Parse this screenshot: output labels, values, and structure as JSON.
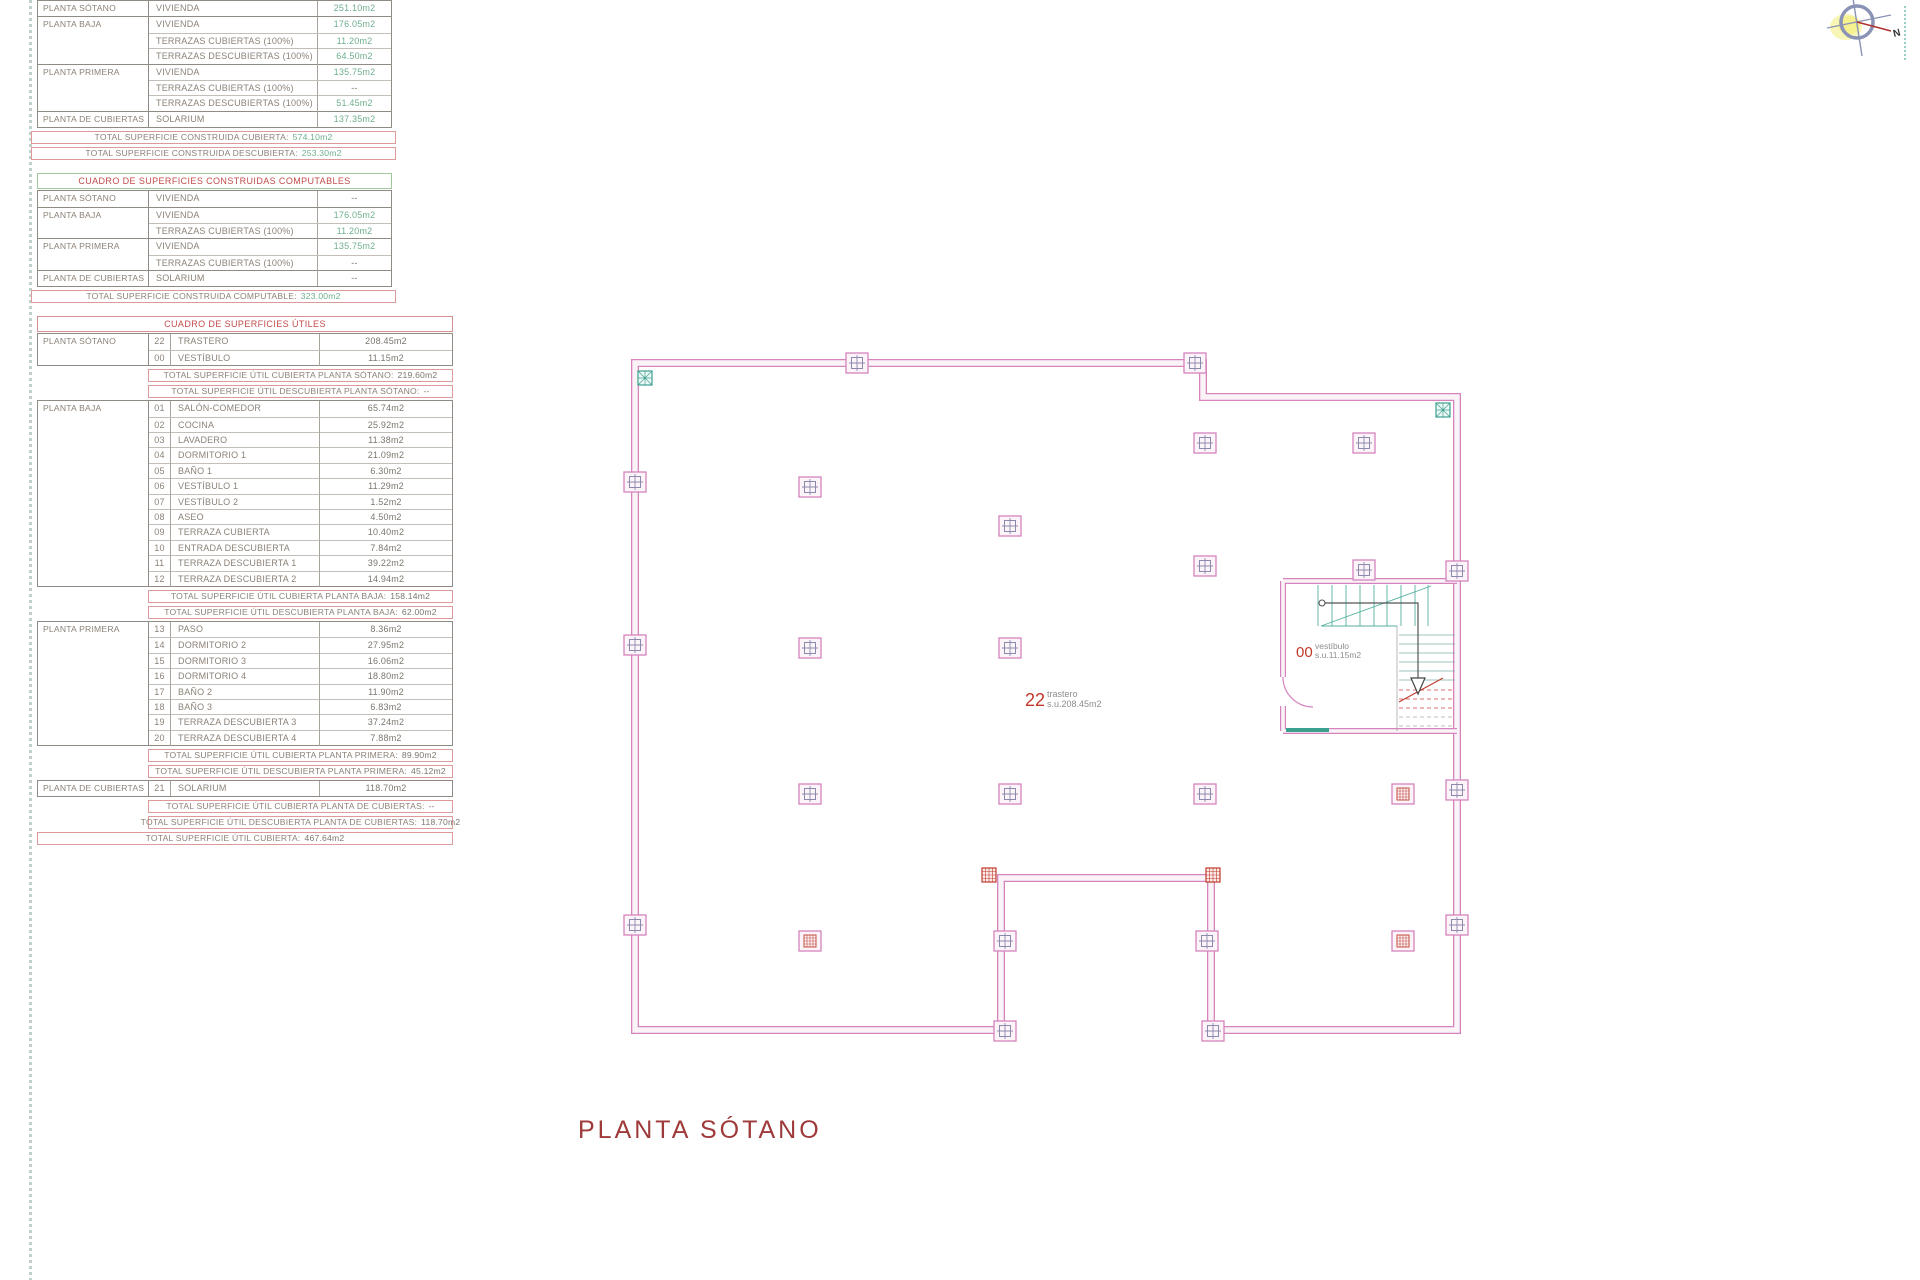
{
  "colors": {
    "wall_pink": "#d584bd",
    "teal": "#3ba08f",
    "red_accent": "#c0392b",
    "value_green": "#6fae8f",
    "title_red": "#9e3a3a",
    "total_bar_border": "#dc9a9a"
  },
  "tables": [
    {
      "name": "cuadro-superficies-construidas",
      "title": null,
      "value_color": "green",
      "has_num_col": false,
      "groups": [
        {
          "planta": "PLANTA SÓTANO",
          "rows": [
            {
              "name": "VIVIENDA",
              "value": "251.10m2"
            }
          ]
        },
        {
          "planta": "PLANTA BAJA",
          "rows": [
            {
              "name": "VIVIENDA",
              "value": "176.05m2"
            },
            {
              "name": "TERRAZAS CUBIERTAS (100%)",
              "value": "11.20m2"
            },
            {
              "name": "TERRAZAS DESCUBIERTAS (100%)",
              "value": "64.50m2"
            }
          ]
        },
        {
          "planta": "PLANTA PRIMERA",
          "rows": [
            {
              "name": "VIVIENDA",
              "value": "135.75m2"
            },
            {
              "name": "TERRAZAS CUBIERTAS (100%)",
              "value": "--"
            },
            {
              "name": "TERRAZAS DESCUBIERTAS (100%)",
              "value": "51.45m2"
            }
          ]
        },
        {
          "planta": "PLANTA DE CUBIERTAS",
          "rows": [
            {
              "name": "SOLARIUM",
              "value": "137.35m2"
            }
          ]
        }
      ],
      "final_totals": [
        {
          "label": "TOTAL SUPERFICIE CONSTRUIDA CUBIERTA:",
          "value": "574.10m2"
        },
        {
          "label": "TOTAL SUPERFICIE CONSTRUIDA DESCUBIERTA:",
          "value": "253.30m2"
        }
      ]
    },
    {
      "name": "cuadro-superficies-construidas-computables",
      "title": "CUADRO DE SUPERFICIES CONSTRUIDAS COMPUTABLES",
      "title_border": "green",
      "value_color": "green",
      "has_num_col": false,
      "groups": [
        {
          "planta": "PLANTA SÓTANO",
          "rows": [
            {
              "name": "VIVIENDA",
              "value": "--"
            }
          ]
        },
        {
          "planta": "PLANTA BAJA",
          "rows": [
            {
              "name": "VIVIENDA",
              "value": "176.05m2"
            },
            {
              "name": "TERRAZAS CUBIERTAS (100%)",
              "value": "11.20m2"
            }
          ]
        },
        {
          "planta": "PLANTA PRIMERA",
          "rows": [
            {
              "name": "VIVIENDA",
              "value": "135.75m2"
            },
            {
              "name": "TERRAZAS CUBIERTAS (100%)",
              "value": "--"
            }
          ]
        },
        {
          "planta": "PLANTA DE CUBIERTAS",
          "rows": [
            {
              "name": "SOLARIUM",
              "value": "--"
            }
          ]
        }
      ],
      "final_totals": [
        {
          "label": "TOTAL SUPERFICIE CONSTRUIDA COMPUTABLE:",
          "value": "323.00m2"
        }
      ]
    },
    {
      "name": "cuadro-superficies-utiles",
      "title": "CUADRO DE SUPERFICIES ÚTILES",
      "title_border": "red",
      "value_color": "gray",
      "has_num_col": true,
      "groups": [
        {
          "planta": "PLANTA SÓTANO",
          "rows": [
            {
              "num": "22",
              "name": "TRASTERO",
              "value": "208.45m2"
            },
            {
              "num": "00",
              "name": "VESTÍBULO",
              "value": "11.15m2"
            }
          ],
          "totals": [
            {
              "label": "TOTAL SUPERFICIE ÚTIL CUBIERTA PLANTA SÓTANO:",
              "value": "219.60m2"
            },
            {
              "label": "TOTAL SUPERFICIE ÚTIL DESCUBIERTA PLANTA SÓTANO:",
              "value": "--"
            }
          ]
        },
        {
          "planta": "PLANTA BAJA",
          "rows": [
            {
              "num": "01",
              "name": "SALÓN-COMEDOR",
              "value": "65.74m2"
            },
            {
              "num": "02",
              "name": "COCINA",
              "value": "25.92m2"
            },
            {
              "num": "03",
              "name": "LAVADERO",
              "value": "11.38m2"
            },
            {
              "num": "04",
              "name": "DORMITORIO 1",
              "value": "21.09m2"
            },
            {
              "num": "05",
              "name": "BAÑO 1",
              "value": "6.30m2"
            },
            {
              "num": "06",
              "name": "VESTÍBULO 1",
              "value": "11.29m2"
            },
            {
              "num": "07",
              "name": "VESTÍBULO 2",
              "value": "1.52m2"
            },
            {
              "num": "08",
              "name": "ASEO",
              "value": "4.50m2"
            },
            {
              "num": "09",
              "name": "TERRAZA CUBIERTA",
              "value": "10.40m2"
            },
            {
              "num": "10",
              "name": "ENTRADA DESCUBIERTA",
              "value": "7.84m2"
            },
            {
              "num": "11",
              "name": "TERRAZA DESCUBIERTA 1",
              "value": "39.22m2"
            },
            {
              "num": "12",
              "name": "TERRAZA DESCUBIERTA 2",
              "value": "14.94m2"
            }
          ],
          "totals": [
            {
              "label": "TOTAL SUPERFICIE ÚTIL CUBIERTA PLANTA BAJA:",
              "value": "158.14m2"
            },
            {
              "label": "TOTAL SUPERFICIE ÚTIL DESCUBIERTA PLANTA BAJA:",
              "value": "62.00m2"
            }
          ]
        },
        {
          "planta": "PLANTA PRIMERA",
          "rows": [
            {
              "num": "13",
              "name": "PASO",
              "value": "8.36m2"
            },
            {
              "num": "14",
              "name": "DORMITORIO 2",
              "value": "27.95m2"
            },
            {
              "num": "15",
              "name": "DORMITORIO 3",
              "value": "16.06m2"
            },
            {
              "num": "16",
              "name": "DORMITORIO 4",
              "value": "18.80m2"
            },
            {
              "num": "17",
              "name": "BAÑO 2",
              "value": "11.90m2"
            },
            {
              "num": "18",
              "name": "BAÑO 3",
              "value": "6.83m2"
            },
            {
              "num": "19",
              "name": "TERRAZA DESCUBIERTA 3",
              "value": "37.24m2"
            },
            {
              "num": "20",
              "name": "TERRAZA DESCUBIERTA 4",
              "value": "7.88m2"
            }
          ],
          "totals": [
            {
              "label": "TOTAL SUPERFICIE ÚTIL CUBIERTA PLANTA PRIMERA:",
              "value": "89.90m2"
            },
            {
              "label": "TOTAL SUPERFICIE ÚTIL DESCUBIERTA PLANTA PRIMERA:",
              "value": "45.12m2"
            }
          ]
        },
        {
          "planta": "PLANTA DE CUBIERTAS",
          "rows": [
            {
              "num": "21",
              "name": "SOLARIUM",
              "value": "118.70m2"
            }
          ],
          "totals": [
            {
              "label": "TOTAL SUPERFICIE ÚTIL CUBIERTA PLANTA DE CUBIERTAS:",
              "value": "--"
            },
            {
              "label": "TOTAL SUPERFICIE ÚTIL DESCUBIERTA PLANTA DE CUBIERTAS:",
              "value": "118.70m2"
            }
          ]
        }
      ],
      "final_totals": [
        {
          "label": "TOTAL SUPERFICIE ÚTIL CUBIERTA:",
          "value": "467.64m2"
        }
      ]
    }
  ],
  "plan": {
    "title": "PLANTA SÓTANO",
    "room1_num": "22",
    "room1_name": "trastero",
    "room1_area": "s.u.208.45m2",
    "room2_num": "00",
    "room2_name": "vestíbulo",
    "room2_area": "s.u.11.15m2"
  },
  "compass": {
    "label": "N"
  }
}
